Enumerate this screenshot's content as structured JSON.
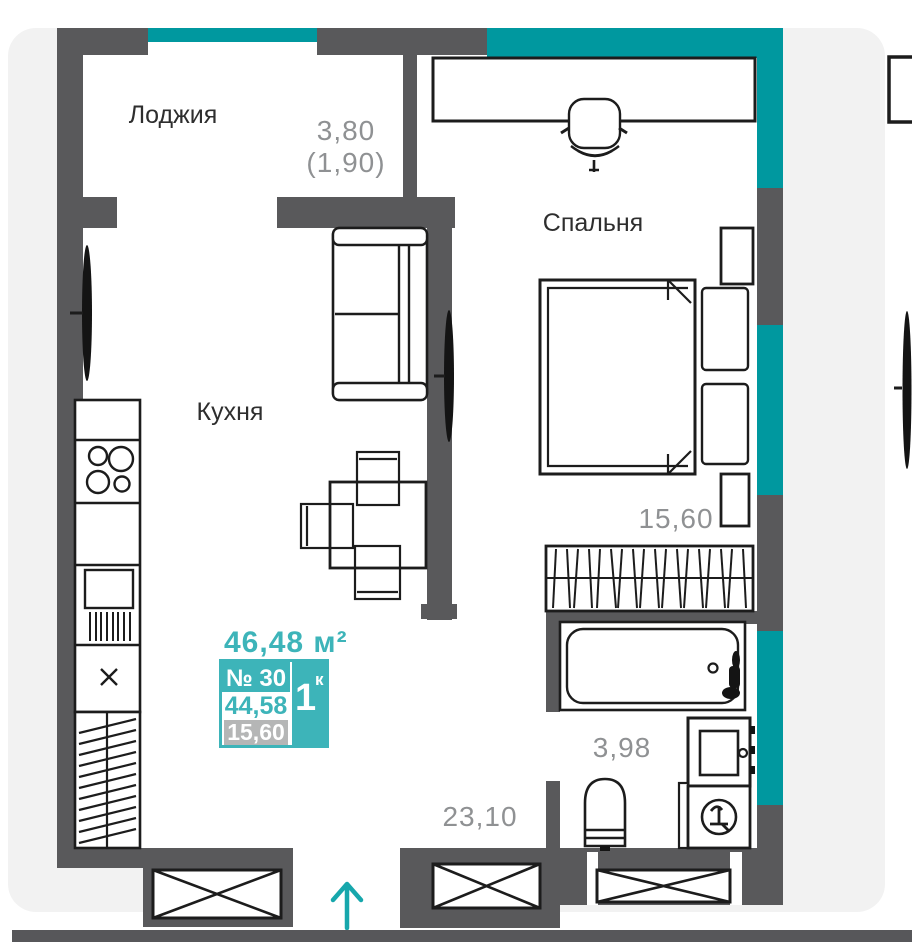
{
  "page": {
    "background": "#ffffff",
    "card_color": "#f2f2f2",
    "bottom_bar_color": "#57575a"
  },
  "plan": {
    "rooms": {
      "loggia": "Лоджия",
      "bedroom": "Спальня",
      "kitchen": "Кухня"
    },
    "areas": {
      "loggia_value": "3,80",
      "loggia_reduced": "(1,90)",
      "bedroom_value": "15,60",
      "bathroom_value": "3,98",
      "kitchen_living_value": "23,10"
    },
    "badge": {
      "total_area": "46,48 м²",
      "unit_number": "№ 30",
      "rooms_count": "1",
      "rooms_suffix": "к",
      "area_middle": "44,58",
      "area_bottom": "15,60"
    },
    "colors": {
      "facade_accent": "#00989f",
      "badge_accent": "#3db4b9",
      "arrow_accent": "#17a7ac",
      "wall": "#59595b",
      "gray_text": "#8f9193",
      "dark_text": "#2e2e2e",
      "muted_box": "#b5b6b6"
    },
    "icons": {
      "entrance_arrow": "up-arrow"
    }
  }
}
